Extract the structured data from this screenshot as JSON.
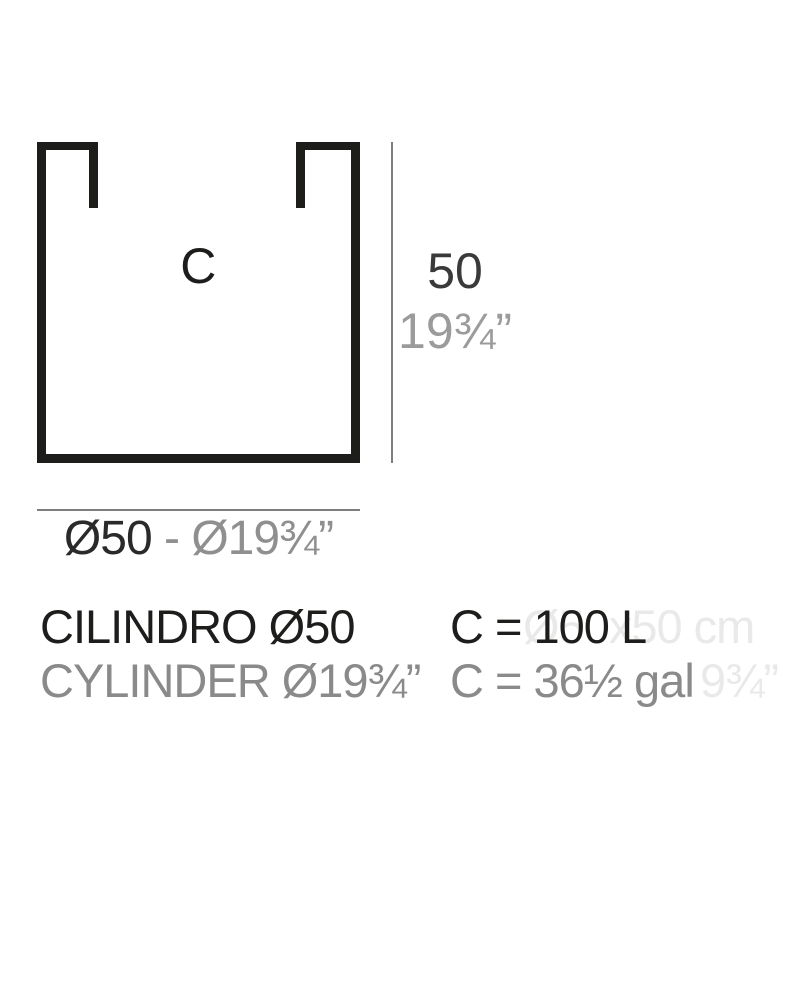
{
  "colors": {
    "ink": "#1d1d1b",
    "gray_text": "#8a8a8a",
    "dim_line": "#7d7d7d",
    "ghost_text": "#e9e9e9",
    "background": "#ffffff"
  },
  "diagram": {
    "vessel_label": "C",
    "height_cm": "50",
    "height_in": "19¾”",
    "diameter_cm": "Ø50",
    "diameter_separator": " - ",
    "diameter_in": "Ø19¾”"
  },
  "specs": {
    "row1": {
      "name": "CILINDRO Ø50",
      "capacity": "C = 100 L",
      "ghost": "Ø50x50 cm"
    },
    "row2": {
      "name": "CYLINDER Ø19¾”",
      "capacity": "C = 36½ gal",
      "ghost": "9¾”"
    }
  }
}
